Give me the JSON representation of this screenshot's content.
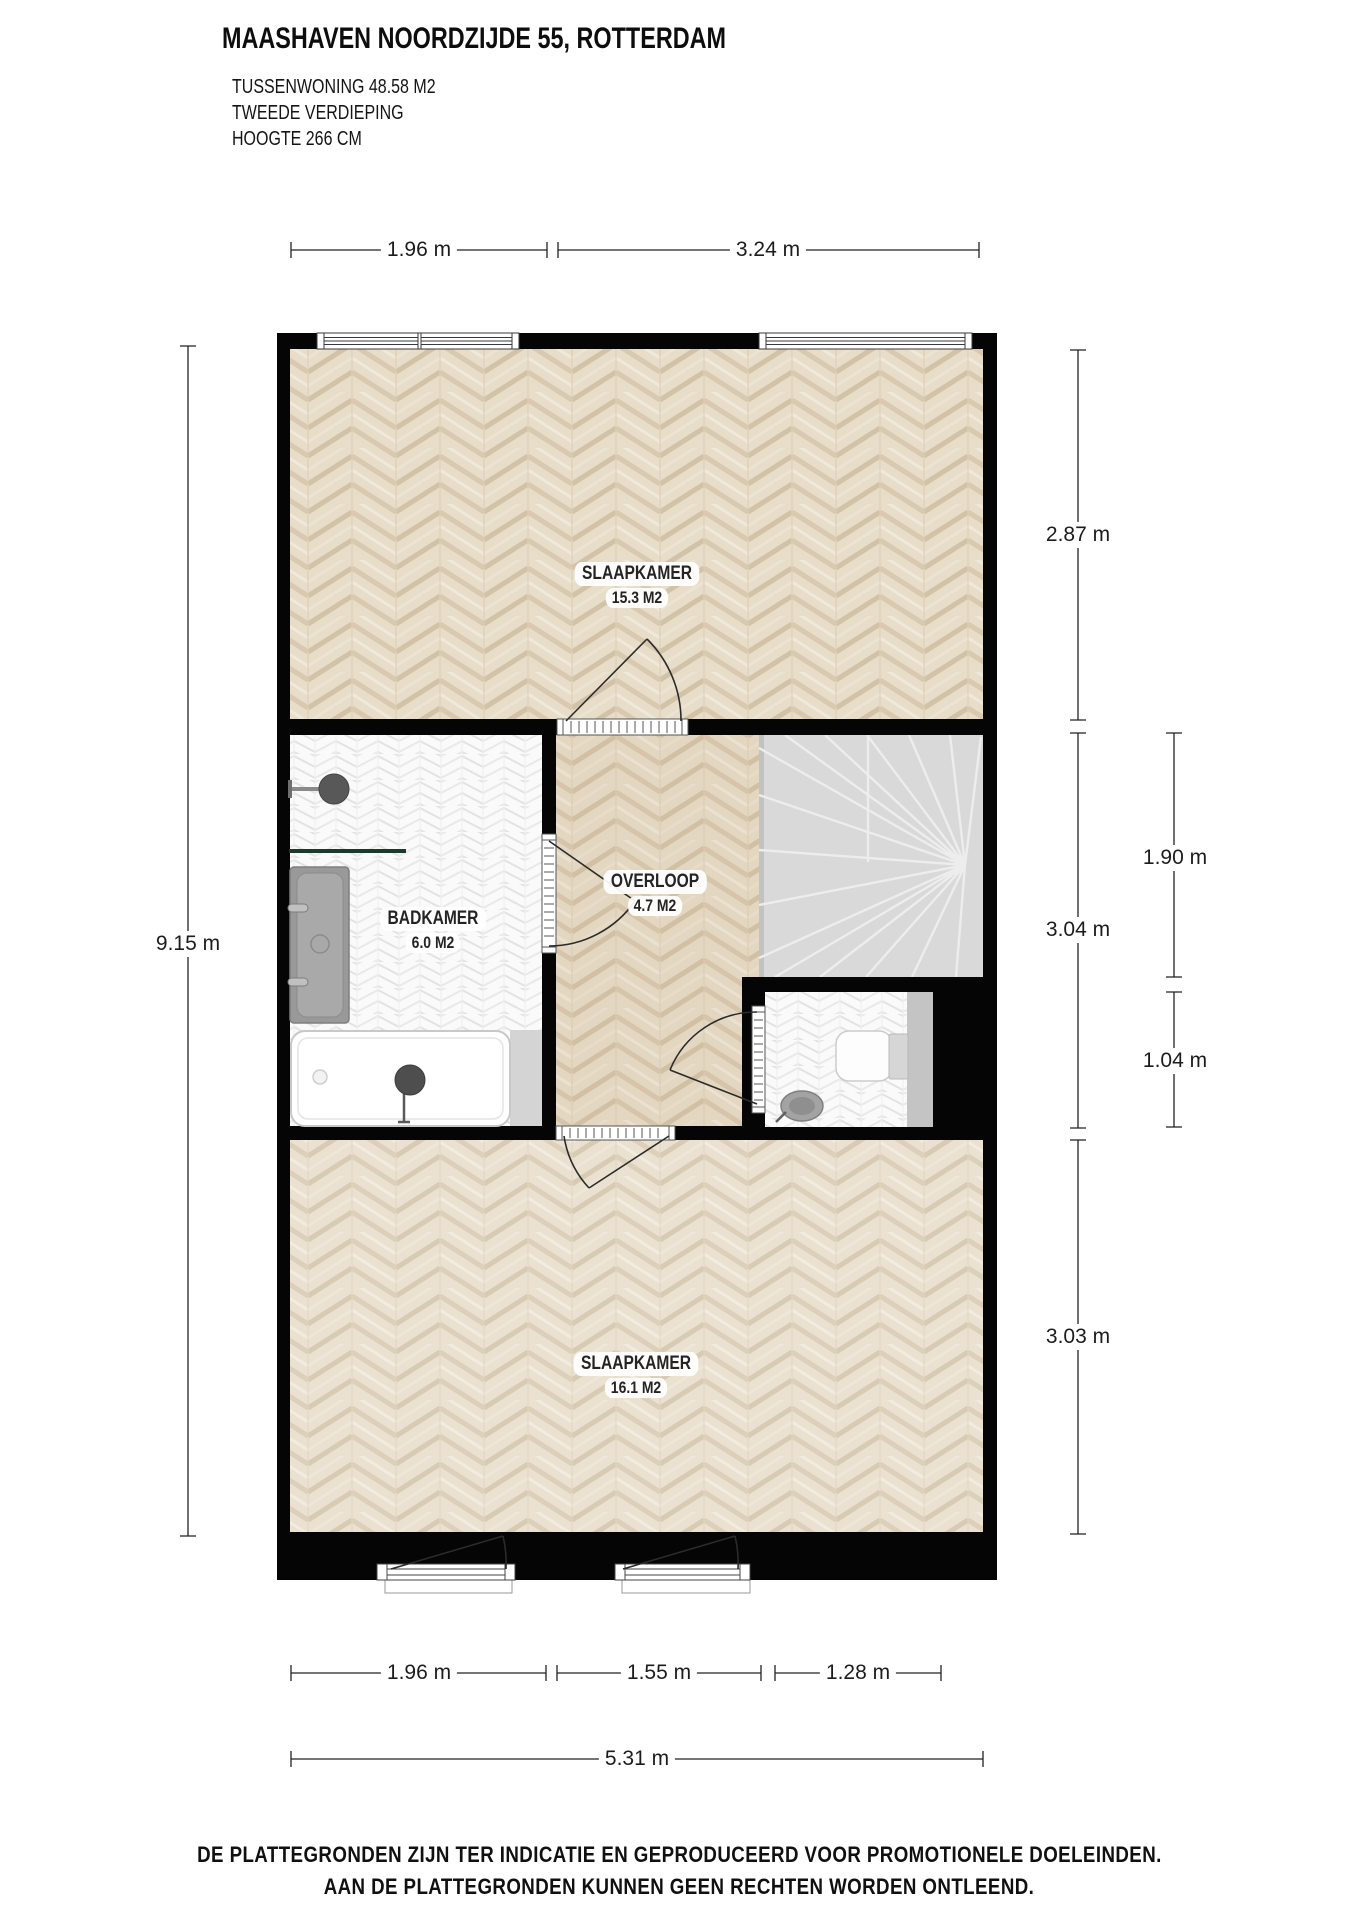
{
  "header": {
    "title": "MAASHAVEN NOORDZIJDE 55, ROTTERDAM",
    "subtitle_lines": [
      "TUSSENWONING 48.58 M2",
      "TWEEDE VERDIEPING",
      "HOOGTE 266 CM"
    ]
  },
  "rooms": [
    {
      "name": "SLAAPKAMER",
      "area": "15.3 M2"
    },
    {
      "name": "BADKAMER",
      "area": "6.0 M2"
    },
    {
      "name": "OVERLOOP",
      "area": "4.7 M2"
    },
    {
      "name": "SLAAPKAMER",
      "area": "16.1 M2"
    }
  ],
  "dimensions": {
    "top": [
      "1.96 m",
      "3.24 m"
    ],
    "left": [
      "9.15 m"
    ],
    "right": [
      "2.87 m",
      "3.04 m",
      "3.03 m",
      "1.90 m",
      "1.04 m"
    ],
    "bottom": [
      "1.96 m",
      "1.55 m",
      "1.28 m",
      "5.31 m"
    ]
  },
  "footer": {
    "lines": [
      "DE PLATTEGRONDEN ZIJN TER INDICATIE EN GEPRODUCEERD VOOR PROMOTIONELE DOELEINDEN.",
      "AAN DE PLATTEGRONDEN KUNNEN GEEN RECHTEN WORDEN ONTLEEND."
    ]
  },
  "colors": {
    "wall": "#050505",
    "parquet": "#e7ddc9",
    "bath_tile": "#fafafa",
    "stairs": "#d9d9d9",
    "fixture_gray": "#9c9c9c",
    "shelf_green": "#1c3a2a"
  }
}
